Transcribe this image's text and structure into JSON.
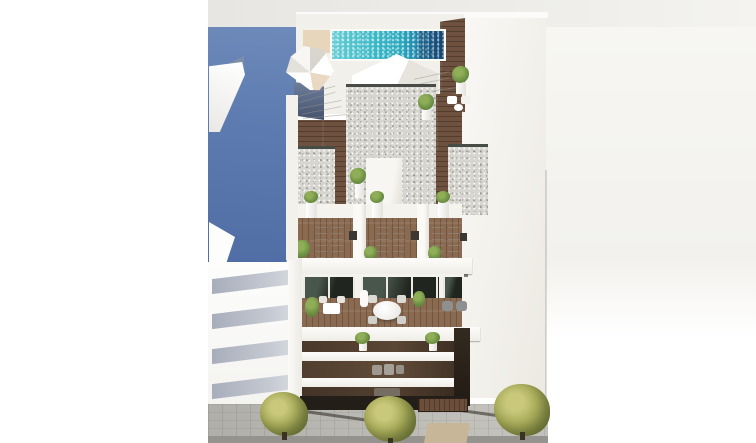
{
  "meta": {
    "title": "Aerial 3D architectural render of a new-build apartment block",
    "description": "Bird's-eye render of a white modern residential building with a turquoise rooftop pool, wooden solarium terraces with sun loungers and parasol, furnished penthouse balcony, three recessed balcony floors, neighbouring buildings (one shaded blue wall, one white slab facade) and a paved sidewalk with three olive-green trees.",
    "visible_text": ""
  },
  "palette": {
    "background_white": "#ffffff",
    "background_warm_gray": "#f6f4f1",
    "top_band_gray": "#eae8e4",
    "shaded_blue_wall": "#5d7bb0",
    "pool_teal": "#2fb0c1",
    "pool_deep_blue": "#17507e",
    "wood_deck_dark": "#6e523f",
    "wood_deck_light": "#8a6a50",
    "gravel_roof": "#d7d5cf",
    "facade_white": "#f3f1ec",
    "beige_mat": "#e7d6bb",
    "glass_dark_green": "#20261f",
    "tree_olive": "#9da04f",
    "pavement_gray": "#b9b8b2",
    "road_gray": "#94938d",
    "neighbor_slab_shadow": "#b6bac4",
    "balcony_recess_brown": "#4a382a",
    "doormat_beige": "#c8b698"
  },
  "scene": {
    "rooftop": {
      "pool_count": 1,
      "parasol_count": 1,
      "sun_loungers": 5,
      "potted_plants": 3,
      "bistro_chairs": 2
    },
    "solarium_level": {
      "terraces": 3,
      "loungers_per_terrace": 2,
      "side_tables": 3,
      "planters": 6
    },
    "penthouse": {
      "glazed_door_groups": 3,
      "round_dining_table": 1,
      "bistro_table": 1,
      "armchairs": 2,
      "plants": 2
    },
    "lower_floors": {
      "balcony_rows": 3,
      "balcony_plants": 2,
      "garage_door": 1
    },
    "street": {
      "trees": 3,
      "tree_shadows": 2,
      "doormat": 1
    },
    "neighbors": {
      "left_building_balcony_slabs": 4,
      "left_awnings": 2,
      "blue_shaded_wall": true
    }
  }
}
